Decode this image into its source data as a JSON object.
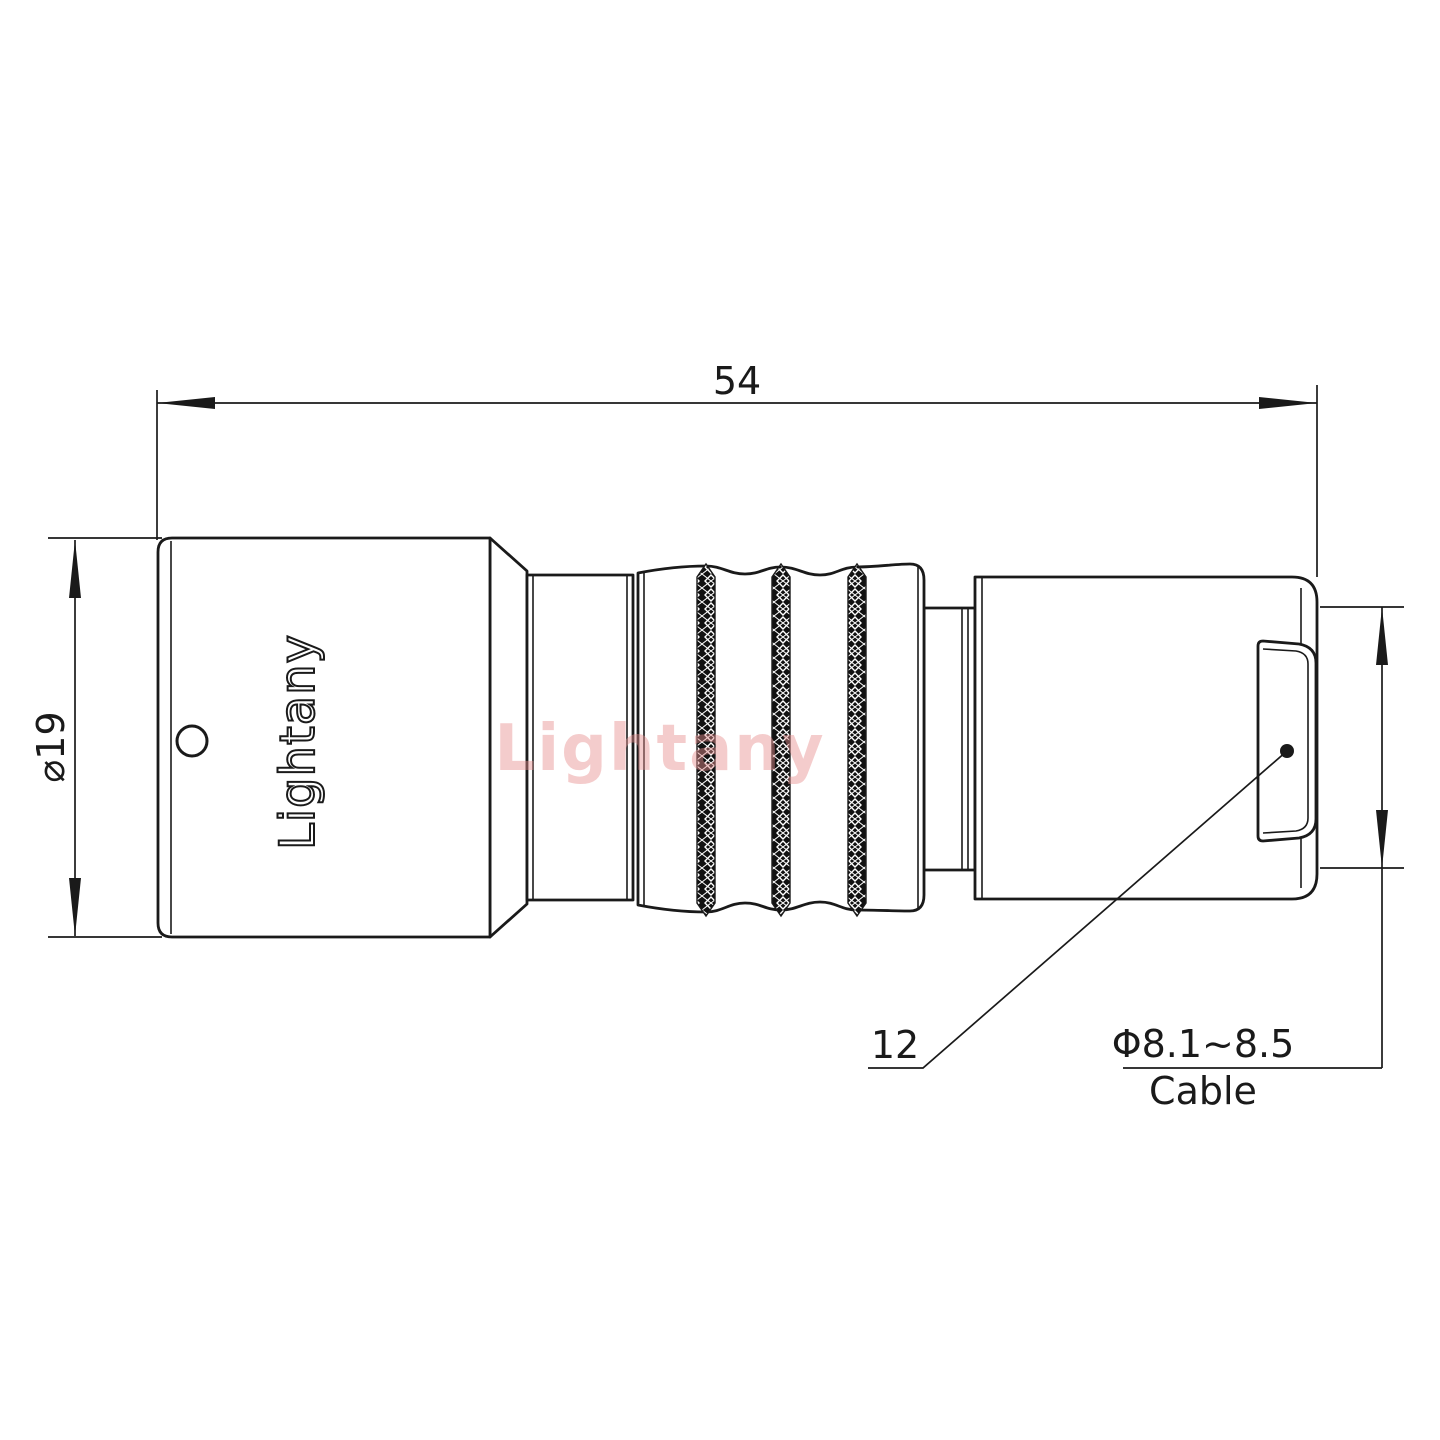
{
  "drawing": {
    "brand_engraving": "Lightany",
    "watermark": "Lightany",
    "dimensions": {
      "overall_length": "54",
      "shell_diameter": "⌀19",
      "bushing_size": "12",
      "cable_diameter_range": "Φ8.1~8.5",
      "cable_label": "Cable"
    },
    "colors": {
      "line": "#1a1a1a",
      "watermark": "#e89090",
      "background": "#ffffff"
    }
  }
}
